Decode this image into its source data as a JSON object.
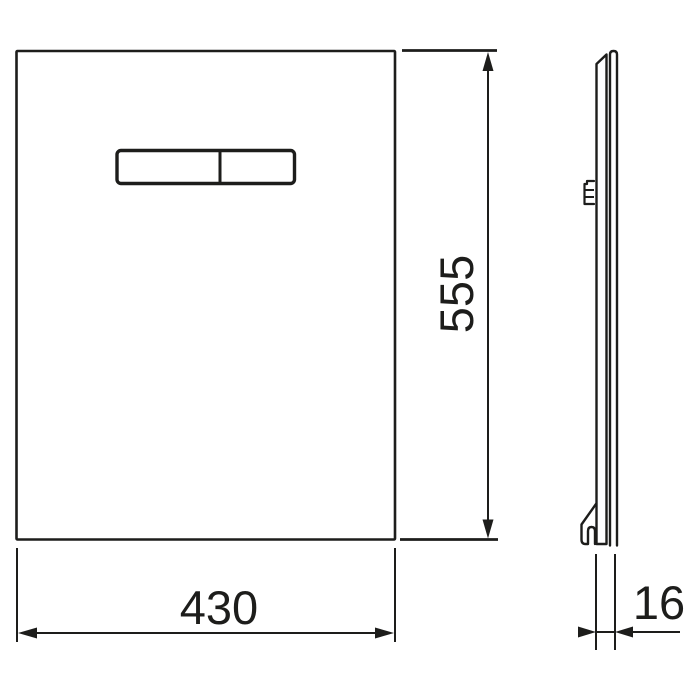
{
  "drawing": {
    "type": "technical-dimension-drawing",
    "subject": "flush-plate-panel-front-and-side-view",
    "colors": {
      "line": "#1d1d1b",
      "background": "#ffffff"
    },
    "dimensions": {
      "width": {
        "label": "430",
        "unit_shown": false,
        "orientation": "horizontal"
      },
      "height": {
        "label": "555",
        "unit_shown": false,
        "orientation": "vertical-rotated"
      },
      "depth": {
        "label": "16",
        "unit_shown": false,
        "orientation": "horizontal"
      }
    }
  }
}
